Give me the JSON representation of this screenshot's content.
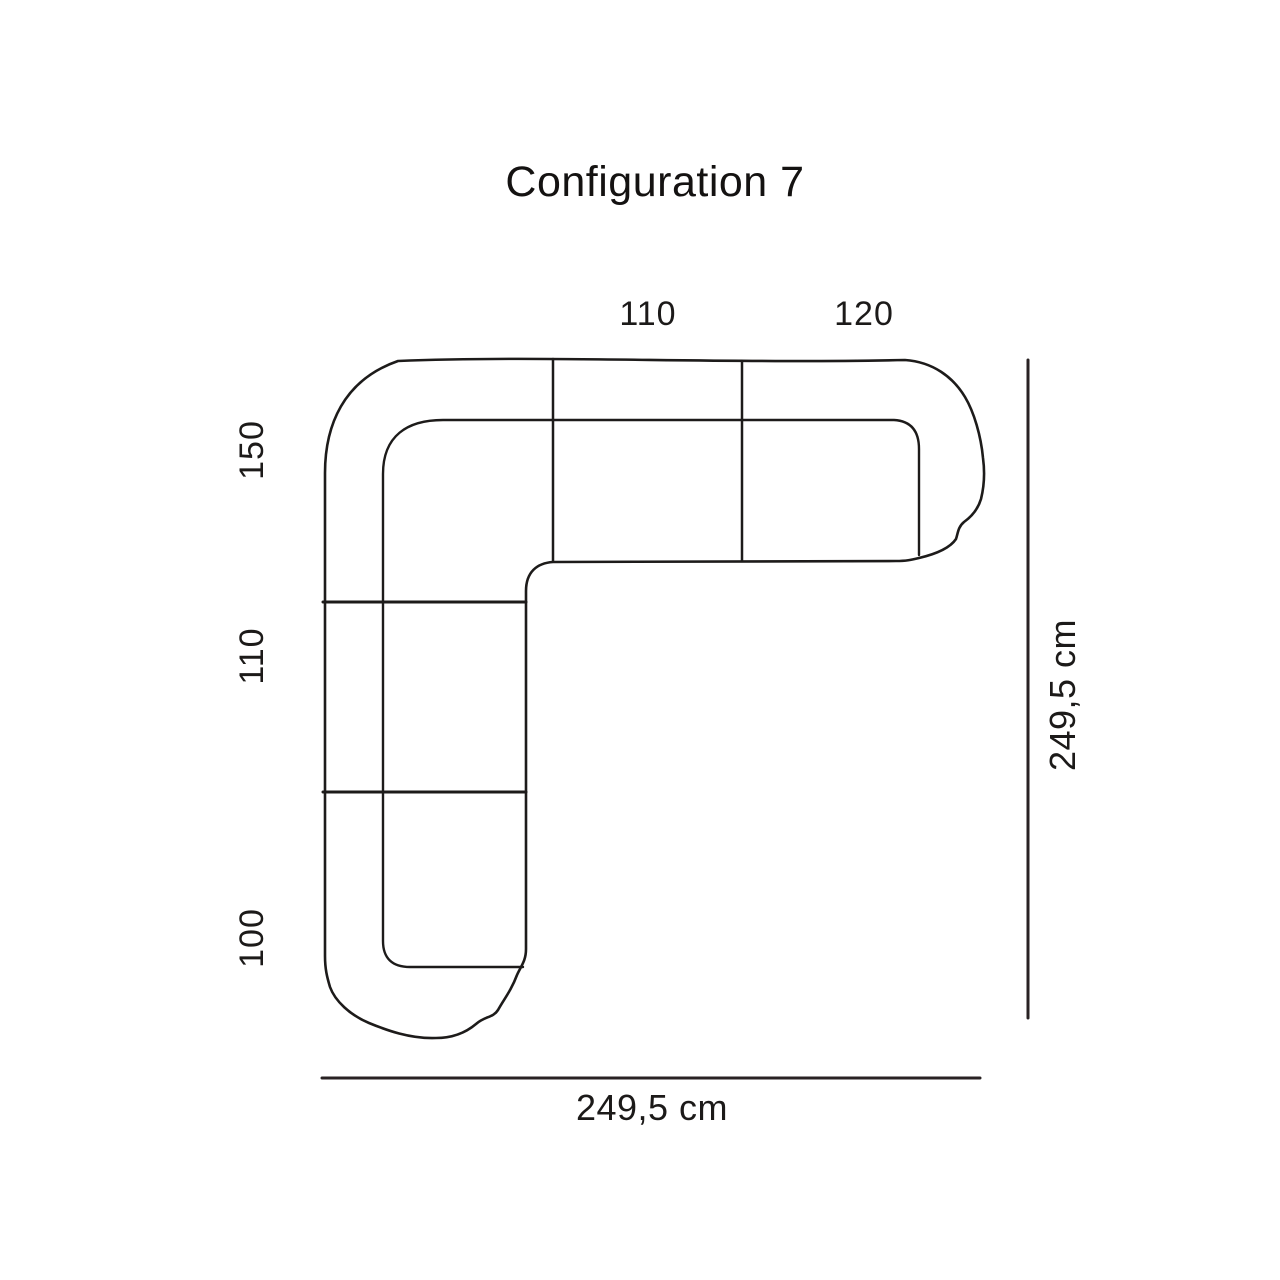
{
  "page": {
    "title": "Configuration 7",
    "background_color": "#ffffff"
  },
  "diagram": {
    "type": "sofa-configuration-top-view",
    "line_color": "#1d1b1a",
    "dimension_line_color": "#292223",
    "text_color": "#1c1a19",
    "top_arm_sections": [
      {
        "label": "110"
      },
      {
        "label": "120"
      }
    ],
    "left_arm_sections": [
      {
        "label": "150"
      },
      {
        "label": "110"
      },
      {
        "label": "100"
      }
    ],
    "total_width": "249,5 cm",
    "total_height": "249,5 cm"
  }
}
